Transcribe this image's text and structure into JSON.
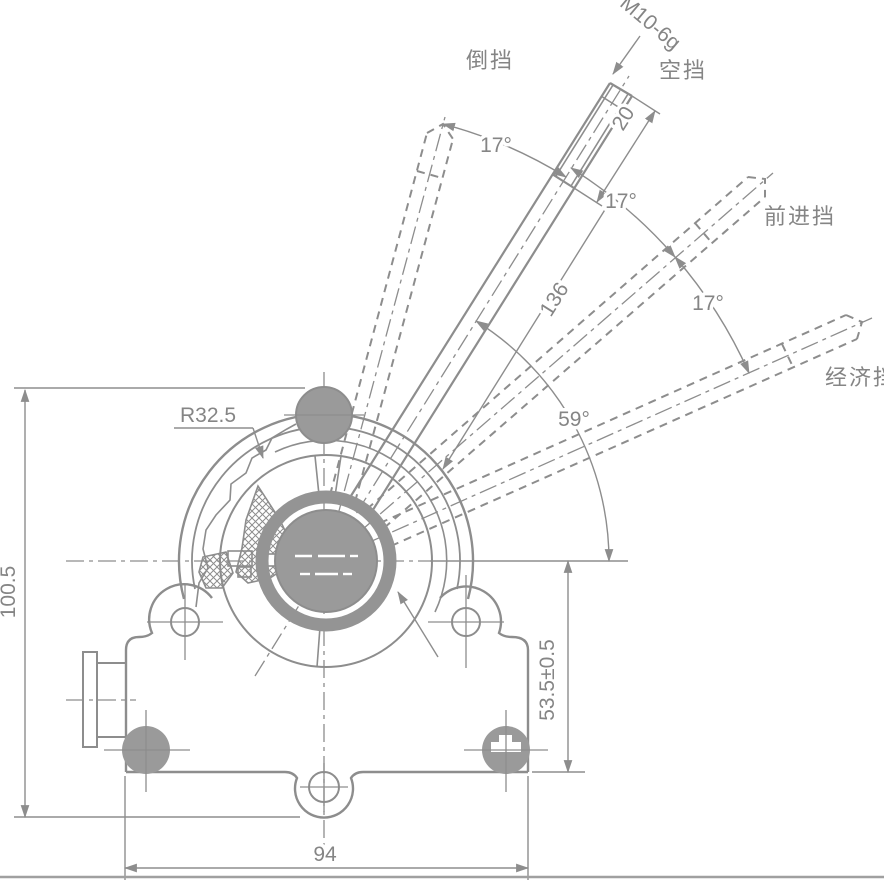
{
  "drawing": {
    "gear_labels": {
      "reverse": "倒挡",
      "neutral": "空挡",
      "forward": "前进挡",
      "economy": "经济挡"
    },
    "dimensions": {
      "thread_spec": "M10-6g",
      "thread_length": "20",
      "angle_reverse_neutral": "17°",
      "angle_neutral_forward": "17°",
      "angle_forward_economy": "17°",
      "lever_length": "136",
      "angle_neutral_to_horizontal": "59°",
      "housing_radius": "R32.5",
      "overall_height": "100.5",
      "pivot_to_base_height": "53.5±0.5",
      "mounting_width": "94"
    },
    "colors": {
      "line": "#8d8d8d",
      "fill": "#9a9a9a",
      "background": "#ffffff"
    }
  }
}
